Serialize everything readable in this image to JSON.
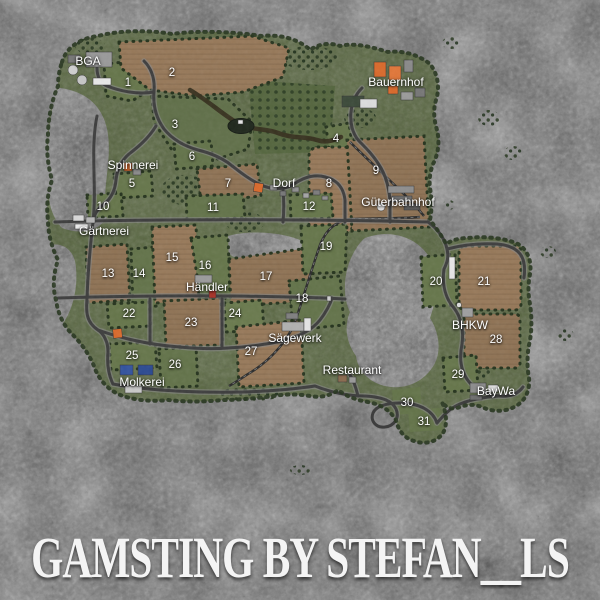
{
  "title": "GAMSTING BY STEFAN__LS",
  "map": {
    "field_numbers": [
      {
        "n": "1",
        "x": 128,
        "y": 83
      },
      {
        "n": "2",
        "x": 172,
        "y": 73
      },
      {
        "n": "3",
        "x": 175,
        "y": 125
      },
      {
        "n": "4",
        "x": 336,
        "y": 139
      },
      {
        "n": "5",
        "x": 132,
        "y": 184
      },
      {
        "n": "6",
        "x": 192,
        "y": 157
      },
      {
        "n": "7",
        "x": 228,
        "y": 184
      },
      {
        "n": "8",
        "x": 329,
        "y": 184
      },
      {
        "n": "9",
        "x": 376,
        "y": 171
      },
      {
        "n": "10",
        "x": 103,
        "y": 207
      },
      {
        "n": "11",
        "x": 213,
        "y": 208
      },
      {
        "n": "12",
        "x": 309,
        "y": 207
      },
      {
        "n": "13",
        "x": 108,
        "y": 274
      },
      {
        "n": "14",
        "x": 139,
        "y": 274
      },
      {
        "n": "15",
        "x": 172,
        "y": 258
      },
      {
        "n": "16",
        "x": 205,
        "y": 266
      },
      {
        "n": "17",
        "x": 266,
        "y": 277
      },
      {
        "n": "18",
        "x": 302,
        "y": 299
      },
      {
        "n": "19",
        "x": 326,
        "y": 247
      },
      {
        "n": "20",
        "x": 436,
        "y": 282
      },
      {
        "n": "21",
        "x": 484,
        "y": 282
      },
      {
        "n": "22",
        "x": 129,
        "y": 314
      },
      {
        "n": "23",
        "x": 191,
        "y": 323
      },
      {
        "n": "24",
        "x": 235,
        "y": 314
      },
      {
        "n": "25",
        "x": 132,
        "y": 356
      },
      {
        "n": "26",
        "x": 175,
        "y": 365
      },
      {
        "n": "27",
        "x": 251,
        "y": 352
      },
      {
        "n": "28",
        "x": 496,
        "y": 340
      },
      {
        "n": "29",
        "x": 458,
        "y": 375
      },
      {
        "n": "30",
        "x": 407,
        "y": 403
      },
      {
        "n": "31",
        "x": 424,
        "y": 422
      }
    ],
    "locations": [
      {
        "name": "BGA",
        "x": 88,
        "y": 61
      },
      {
        "name": "Bauernhof",
        "x": 396,
        "y": 82
      },
      {
        "name": "Spinnerei",
        "x": 133,
        "y": 165
      },
      {
        "name": "Dorf",
        "x": 284,
        "y": 183
      },
      {
        "name": "Güterbahnhof",
        "x": 398,
        "y": 202
      },
      {
        "name": "Gärtnerei",
        "x": 104,
        "y": 231
      },
      {
        "name": "Händler",
        "x": 207,
        "y": 287
      },
      {
        "name": "Sägewerk",
        "x": 295,
        "y": 338
      },
      {
        "name": "BHKW",
        "x": 470,
        "y": 325
      },
      {
        "name": "Molkerei",
        "x": 142,
        "y": 382
      },
      {
        "name": "Restaurant",
        "x": 352,
        "y": 370
      },
      {
        "name": "BayWa",
        "x": 496,
        "y": 391
      }
    ],
    "colors": {
      "rock_background": "#6a6a6a",
      "grass": "#57653f",
      "meadow_light": "#66764b",
      "field_brown": "#8f7355",
      "road": "#3e3e3e",
      "building_orange": "#d96a2c",
      "building_red": "#a83228",
      "building_blue": "#33539e",
      "label_text": "#ffffff",
      "title_text": "#f4f4f4"
    }
  }
}
